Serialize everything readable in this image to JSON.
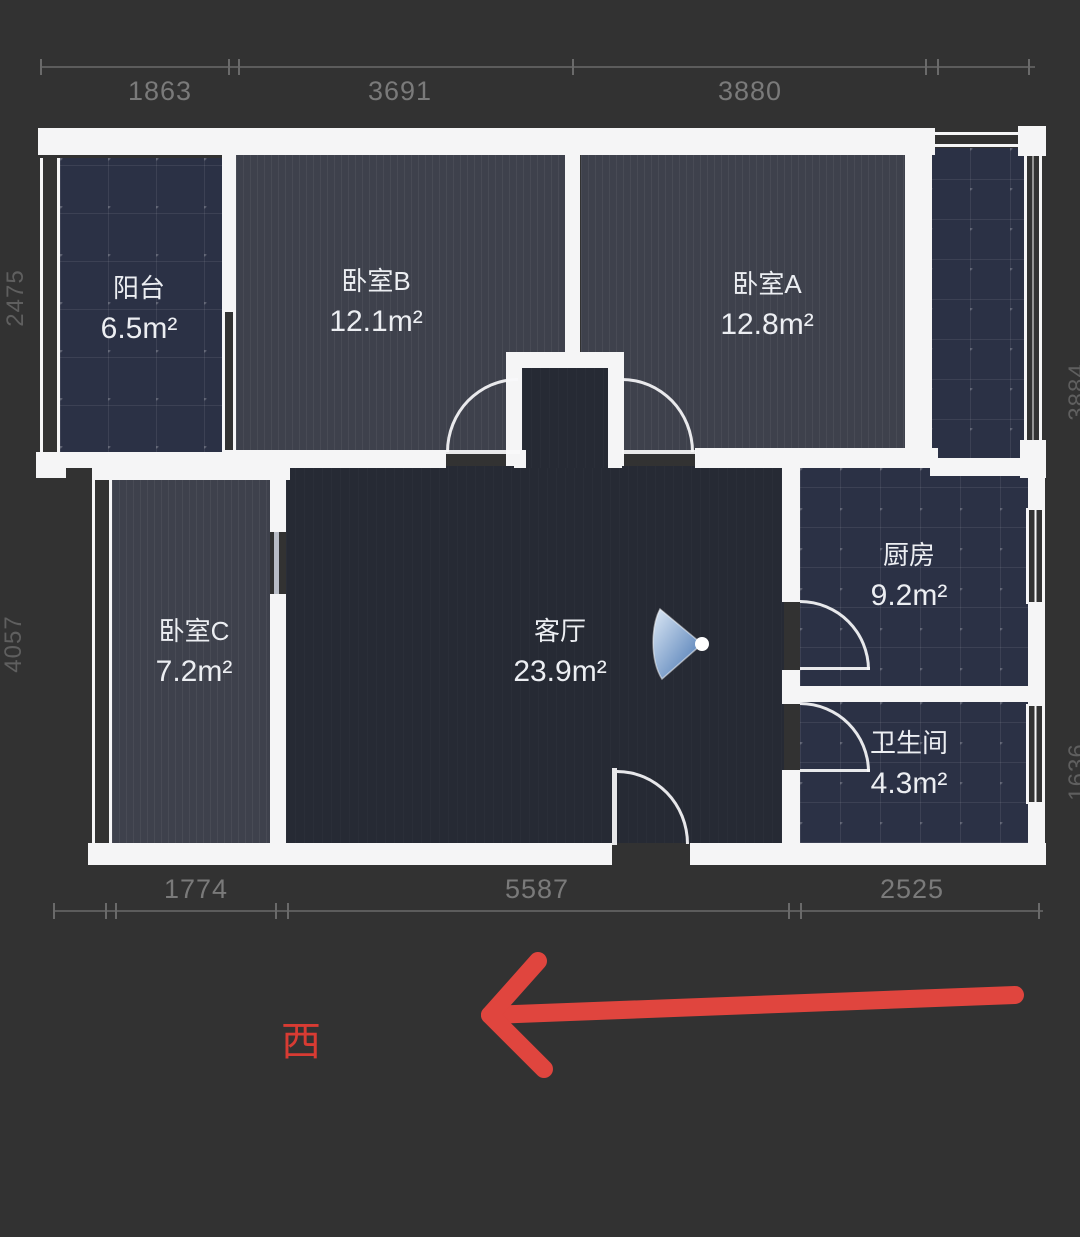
{
  "plan": {
    "rooms": [
      {
        "name": "阳台",
        "area": "6.5m²"
      },
      {
        "name": "卧室B",
        "area": "12.1m²"
      },
      {
        "name": "卧室A",
        "area": "12.8m²"
      },
      {
        "name": "卧室C",
        "area": "7.2m²"
      },
      {
        "name": "客厅",
        "area": "23.9m²"
      },
      {
        "name": "厨房",
        "area": "9.2m²"
      },
      {
        "name": "卫生间",
        "area": "4.3m²"
      }
    ],
    "dimensions": {
      "top": [
        "1863",
        "3691",
        "3880"
      ],
      "bottom": [
        "1774",
        "5587",
        "2525"
      ],
      "left": [
        "2475",
        "4057"
      ],
      "right": [
        "3884",
        "1636"
      ]
    },
    "compass": {
      "west": "西"
    },
    "colors": {
      "background": "#323232",
      "wall": "#f5f5f6",
      "room_wood_floor": "#3e414c",
      "room_tile_floor": "#2b3145",
      "room_living_floor": "#262a34",
      "dimension_text": "#7a7a7a",
      "arrow_red": "#e0453e",
      "view_cone_blue": "#3f6fae"
    },
    "icons": [
      "view-cone-icon",
      "west-arrow-icon"
    ]
  }
}
